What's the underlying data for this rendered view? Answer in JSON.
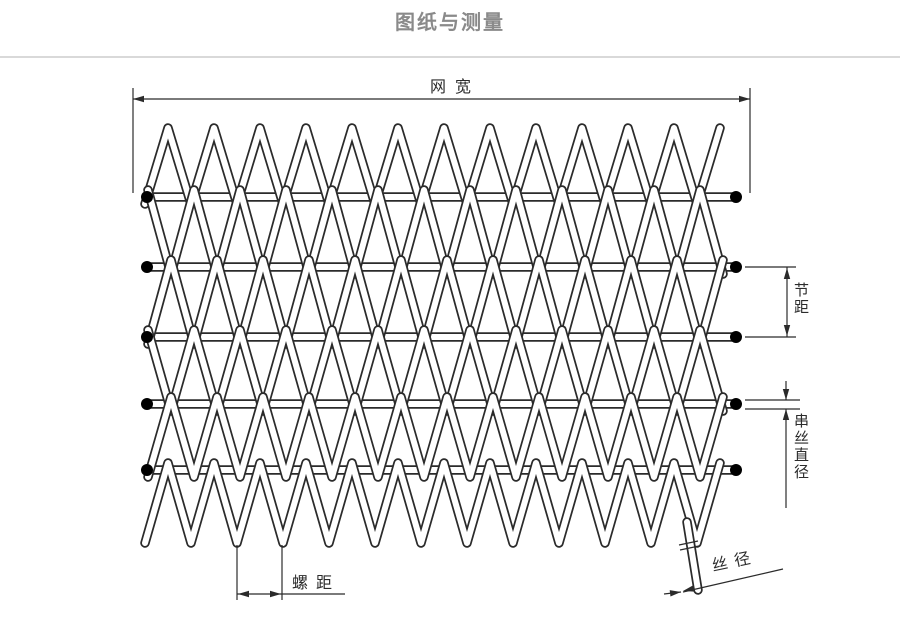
{
  "page": {
    "title": "图纸与测量"
  },
  "colors": {
    "title_text": "#8a8a8a",
    "divider": "#d9d9d9",
    "ink": "#2b2b2b",
    "wire_fill": "#ffffff",
    "rod_end_dot": "#000000",
    "background": "#ffffff"
  },
  "diagram": {
    "labels": {
      "mesh_width": "网宽",
      "pitch": "节距",
      "cross_wire_diameter": "串丝直径",
      "spiral_pitch": "螺距",
      "wire_diameter": "丝径"
    },
    "structure": {
      "cross_rod_count": 5,
      "rod_end_dots_per_rod": 2,
      "spiral_band_count": 6
    }
  }
}
